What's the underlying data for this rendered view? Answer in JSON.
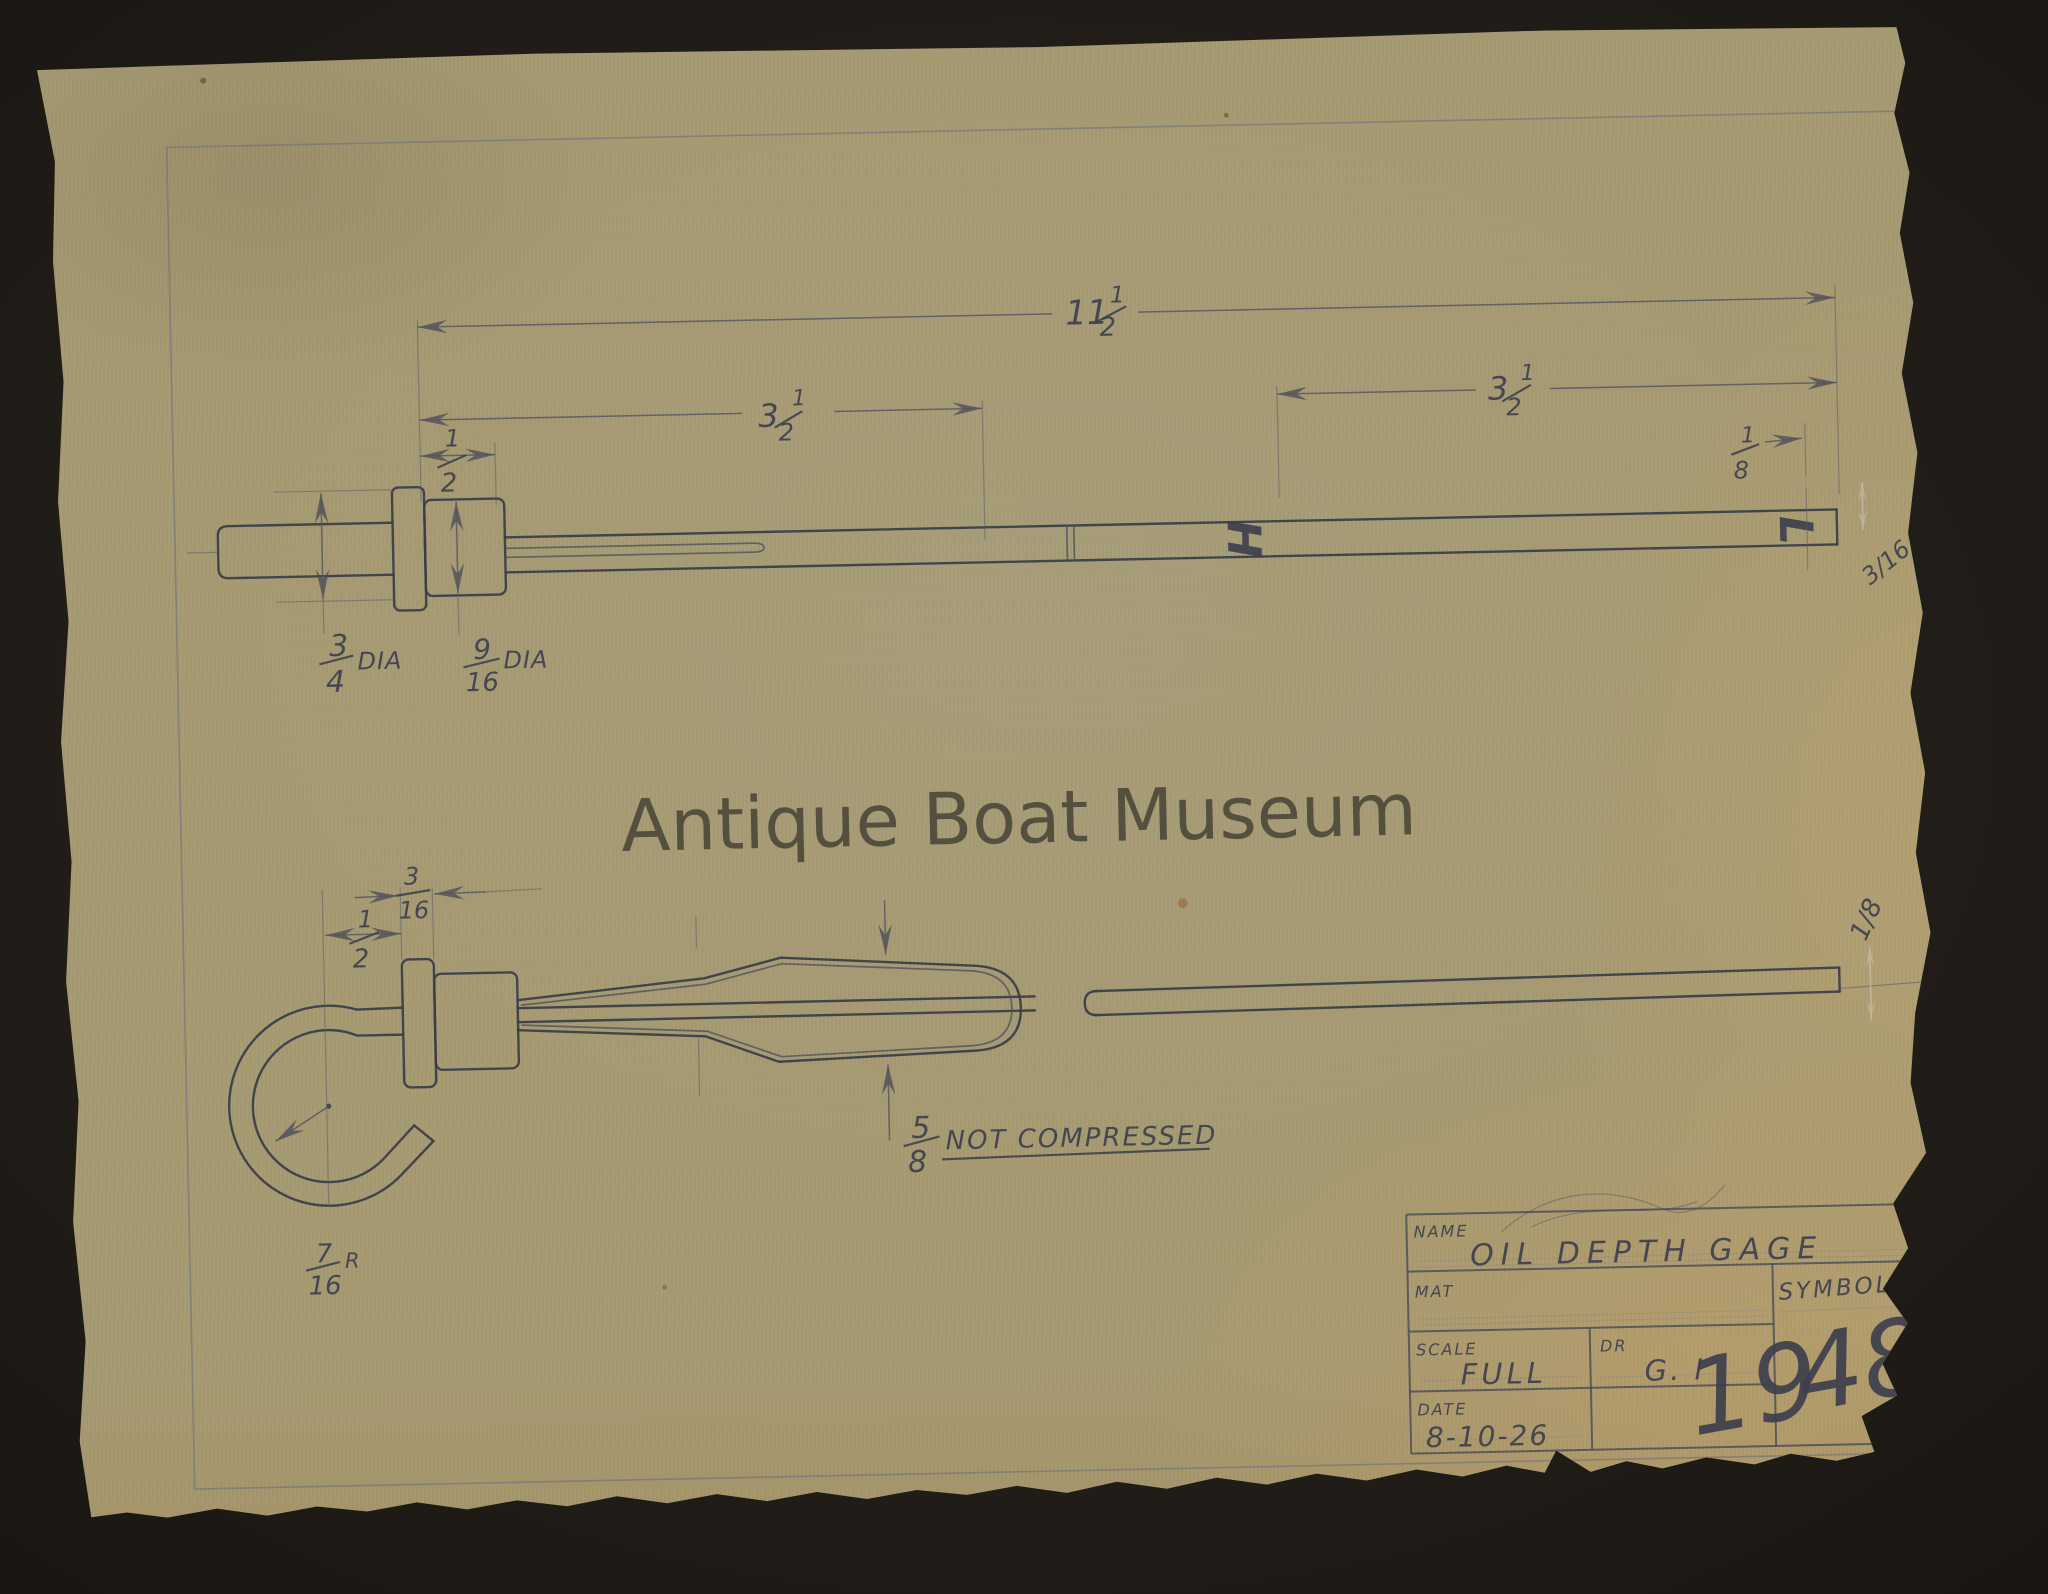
{
  "watermark": {
    "text": "Antique Boat Museum"
  },
  "drawing": {
    "dimensions": {
      "overall": {
        "whole": "11",
        "num": "1",
        "den": "2"
      },
      "left_section": {
        "whole": "3",
        "num": "1",
        "den": "2"
      },
      "right_section": {
        "whole": "3",
        "num": "1",
        "den": "2"
      },
      "cap_width": {
        "num": "1",
        "den": "2"
      },
      "tip_width": {
        "num": "1",
        "den": "8"
      },
      "flange_dia": {
        "num": "3",
        "den": "4",
        "suffix": "DIA"
      },
      "hex_dia": {
        "num": "9",
        "den": "16",
        "suffix": "DIA"
      },
      "loop_offset": {
        "num": "1",
        "den": "2"
      },
      "flange_thickness": {
        "num": "3",
        "den": "16"
      },
      "loop_radius": {
        "num": "7",
        "den": "16",
        "suffix": "R"
      },
      "spring": {
        "num": "5",
        "den": "8",
        "note": "NOT COMPRESSED"
      }
    },
    "stamped_letters": {
      "high": "H",
      "low": "L"
    },
    "white_pencil_marks": {
      "top_view": "3/16",
      "bottom_view": "1/8"
    }
  },
  "title_block": {
    "name_label": "NAME",
    "name_value": "OIL DEPTH GAGE",
    "mat_label": "MAT",
    "mat_value": "",
    "scale_label": "SCALE",
    "scale_value": "FULL",
    "dr_label": "DR",
    "dr_value": "G. I",
    "date_label": "DATE",
    "date_value": "8-10-26",
    "symbol_label": "SYMBOL",
    "symbol_number": {
      "light": "19",
      "dark": "48"
    }
  },
  "colors": {
    "paper": "#a69a72",
    "pencil": "#3b3e4d",
    "background": "#1e1a16",
    "white_pencil": "#d2ccbd"
  }
}
